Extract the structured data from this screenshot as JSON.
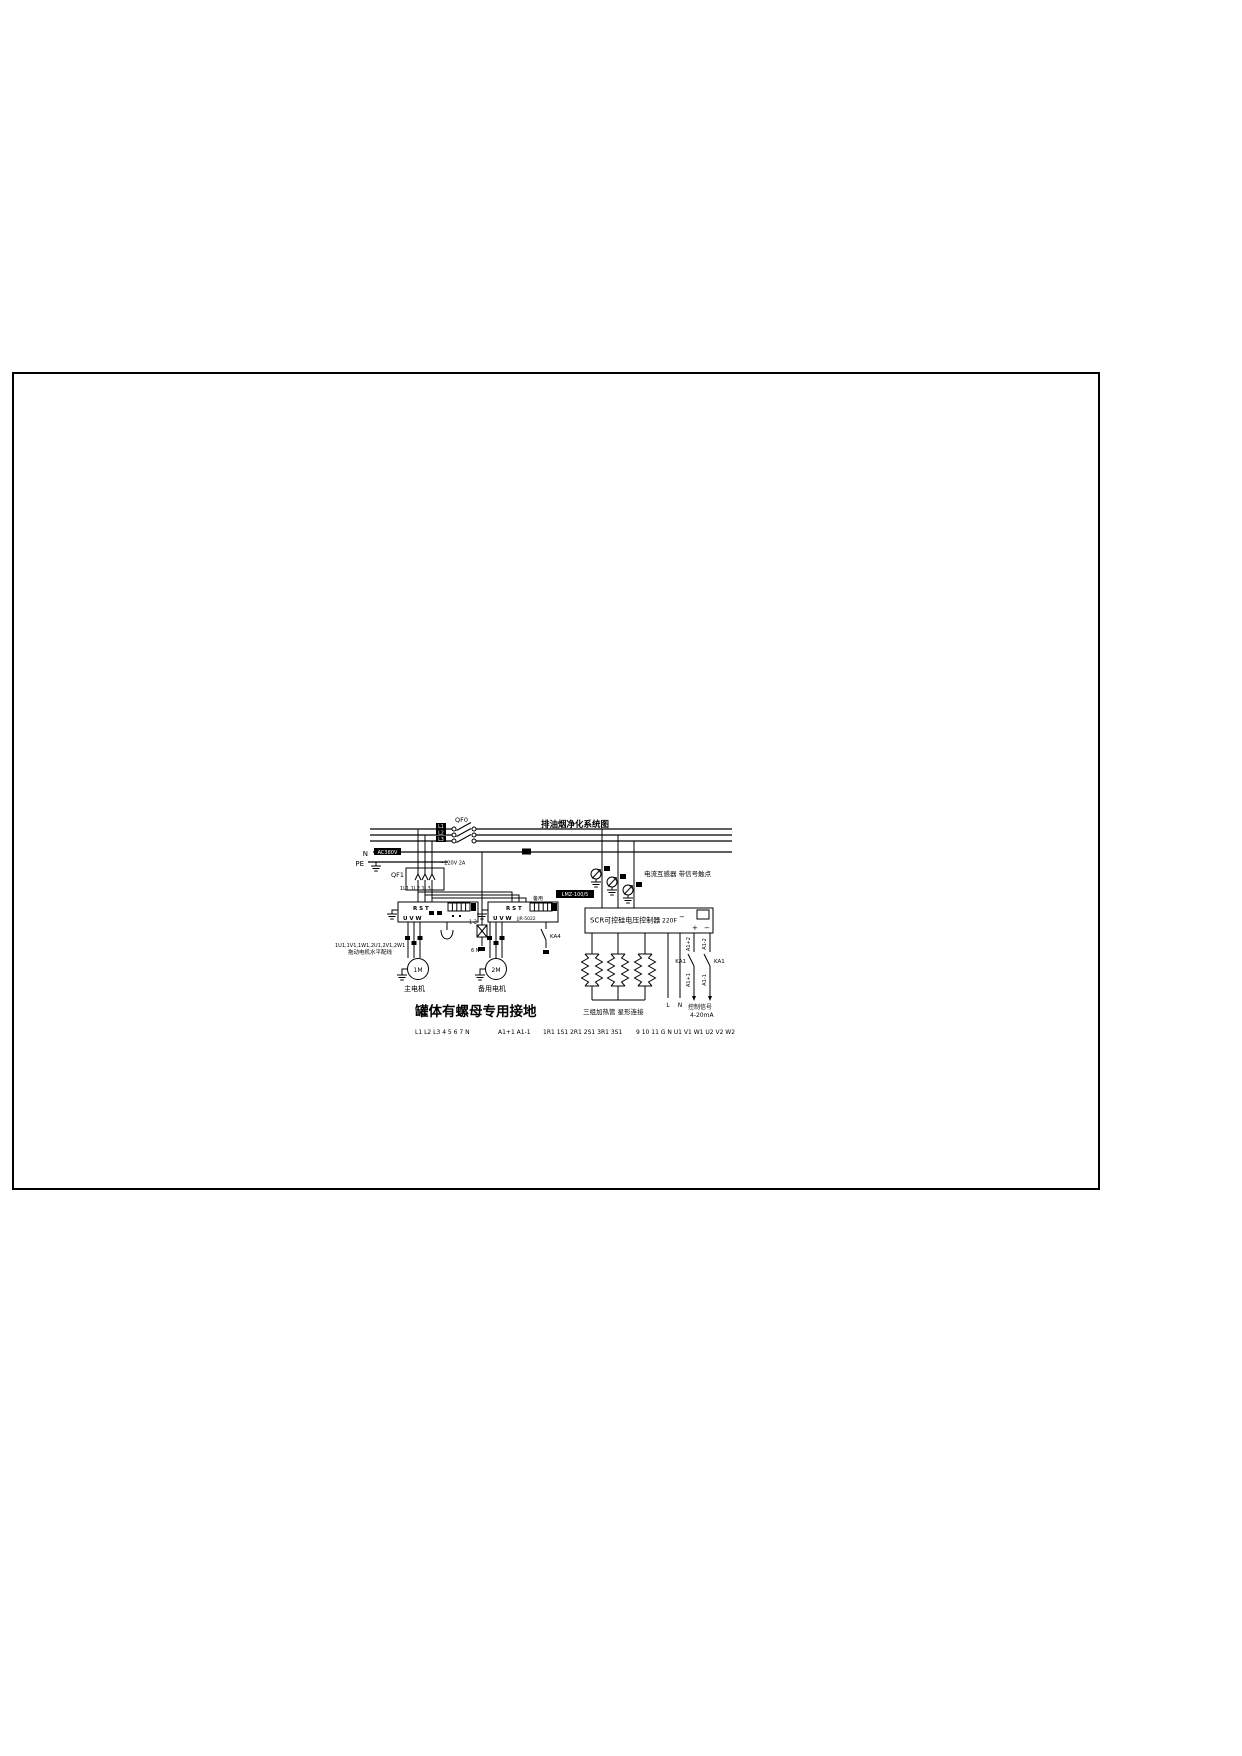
{
  "banner": {
    "title": "排油烟净化系统图"
  },
  "bus": {
    "neutral_label": "N",
    "pe_label": "PE",
    "voltage_tag": "AC380V",
    "phase_tags": {
      "l1": "L1",
      "l2": "L2",
      "l3": "L3"
    }
  },
  "breakers": {
    "qf0": "QF0",
    "qf1": "QF1"
  },
  "tap": {
    "label": "~220V 2A",
    "fuse_terminals": "1 2",
    "neutral_terminals": "6 N"
  },
  "starter1": {
    "feed": "1L1 1L2 1L3",
    "in": "R S T",
    "out": "U V W"
  },
  "starter2": {
    "spare": "备用",
    "in": "R S T",
    "out": "U V W",
    "model": "JJR-5022",
    "relay": "KA4"
  },
  "motors": {
    "m1_tag": "1M",
    "m1_name": "主电机",
    "m2_tag": "2M",
    "m2_name": "备用电机",
    "note1": "1U1,1V1,1W1,2U1,2V1,2W1",
    "note2": "拖动电机水平配线"
  },
  "grounding_title": "罐体有螺母专用接地",
  "ct": {
    "ratio": "LMZ-100/5",
    "note": "电流互感器 带信号触点"
  },
  "scr": {
    "title": "SCR可控硅电压控制器",
    "model": "220F",
    "plus": "+",
    "minus": "−"
  },
  "heater": {
    "caption": "三组加热管 星形连接",
    "live_label": "L",
    "neutral_label": "N"
  },
  "control": {
    "a1p2": "A1+2",
    "a1p1": "A1+1",
    "a1m2": "A1-2",
    "a1m1": "A1-1",
    "relay_left": "KA1",
    "relay_right": "KA1",
    "caption1": "控制信号",
    "caption2": "4-20mA"
  },
  "terminals": {
    "group1": "L1 L2 L3 4 5 6 7 N",
    "group2": "A1+1 A1-1",
    "group3": "1R1 1S1 2R1 2S1 3R1 3S1",
    "group4": "9 10 11 G N U1 V1 W1 U2 V2 W2"
  }
}
